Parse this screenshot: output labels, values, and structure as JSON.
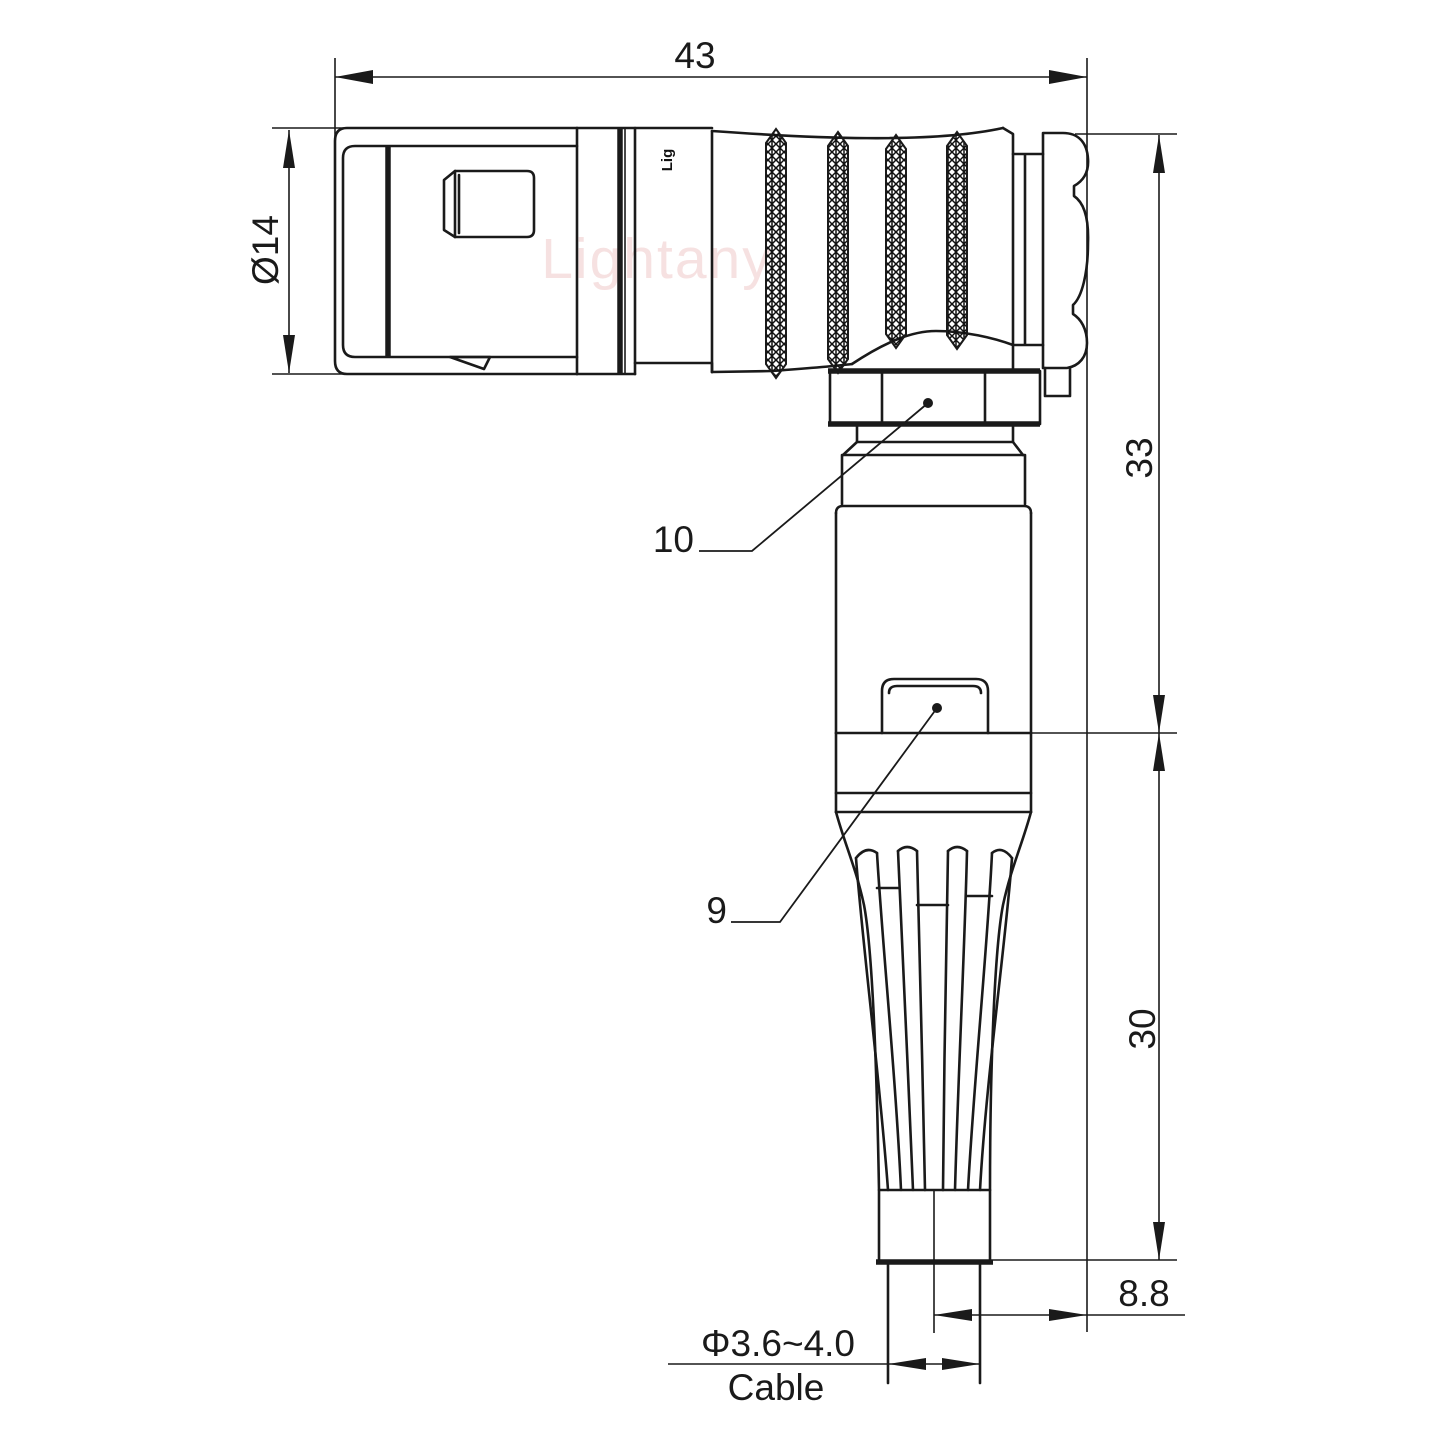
{
  "watermark": {
    "text": "Lightany",
    "color": "#eec9c9"
  },
  "connector": {
    "engraving": "Lig"
  },
  "dimensions": {
    "total_length": {
      "value": "43"
    },
    "rear_diameter": {
      "value": "Ø14"
    },
    "upper_height": {
      "value": "33"
    },
    "lower_height": {
      "value": "30"
    },
    "axis_offset": {
      "value": "8.8"
    },
    "cable_diameter": {
      "value": "Φ3.6~4.0"
    },
    "cable_label": {
      "value": "Cable"
    }
  },
  "part_labels": {
    "coupling_nut": "10",
    "cable_clip": "9"
  },
  "colors": {
    "line": "#1a1a1a",
    "background": "#ffffff"
  }
}
